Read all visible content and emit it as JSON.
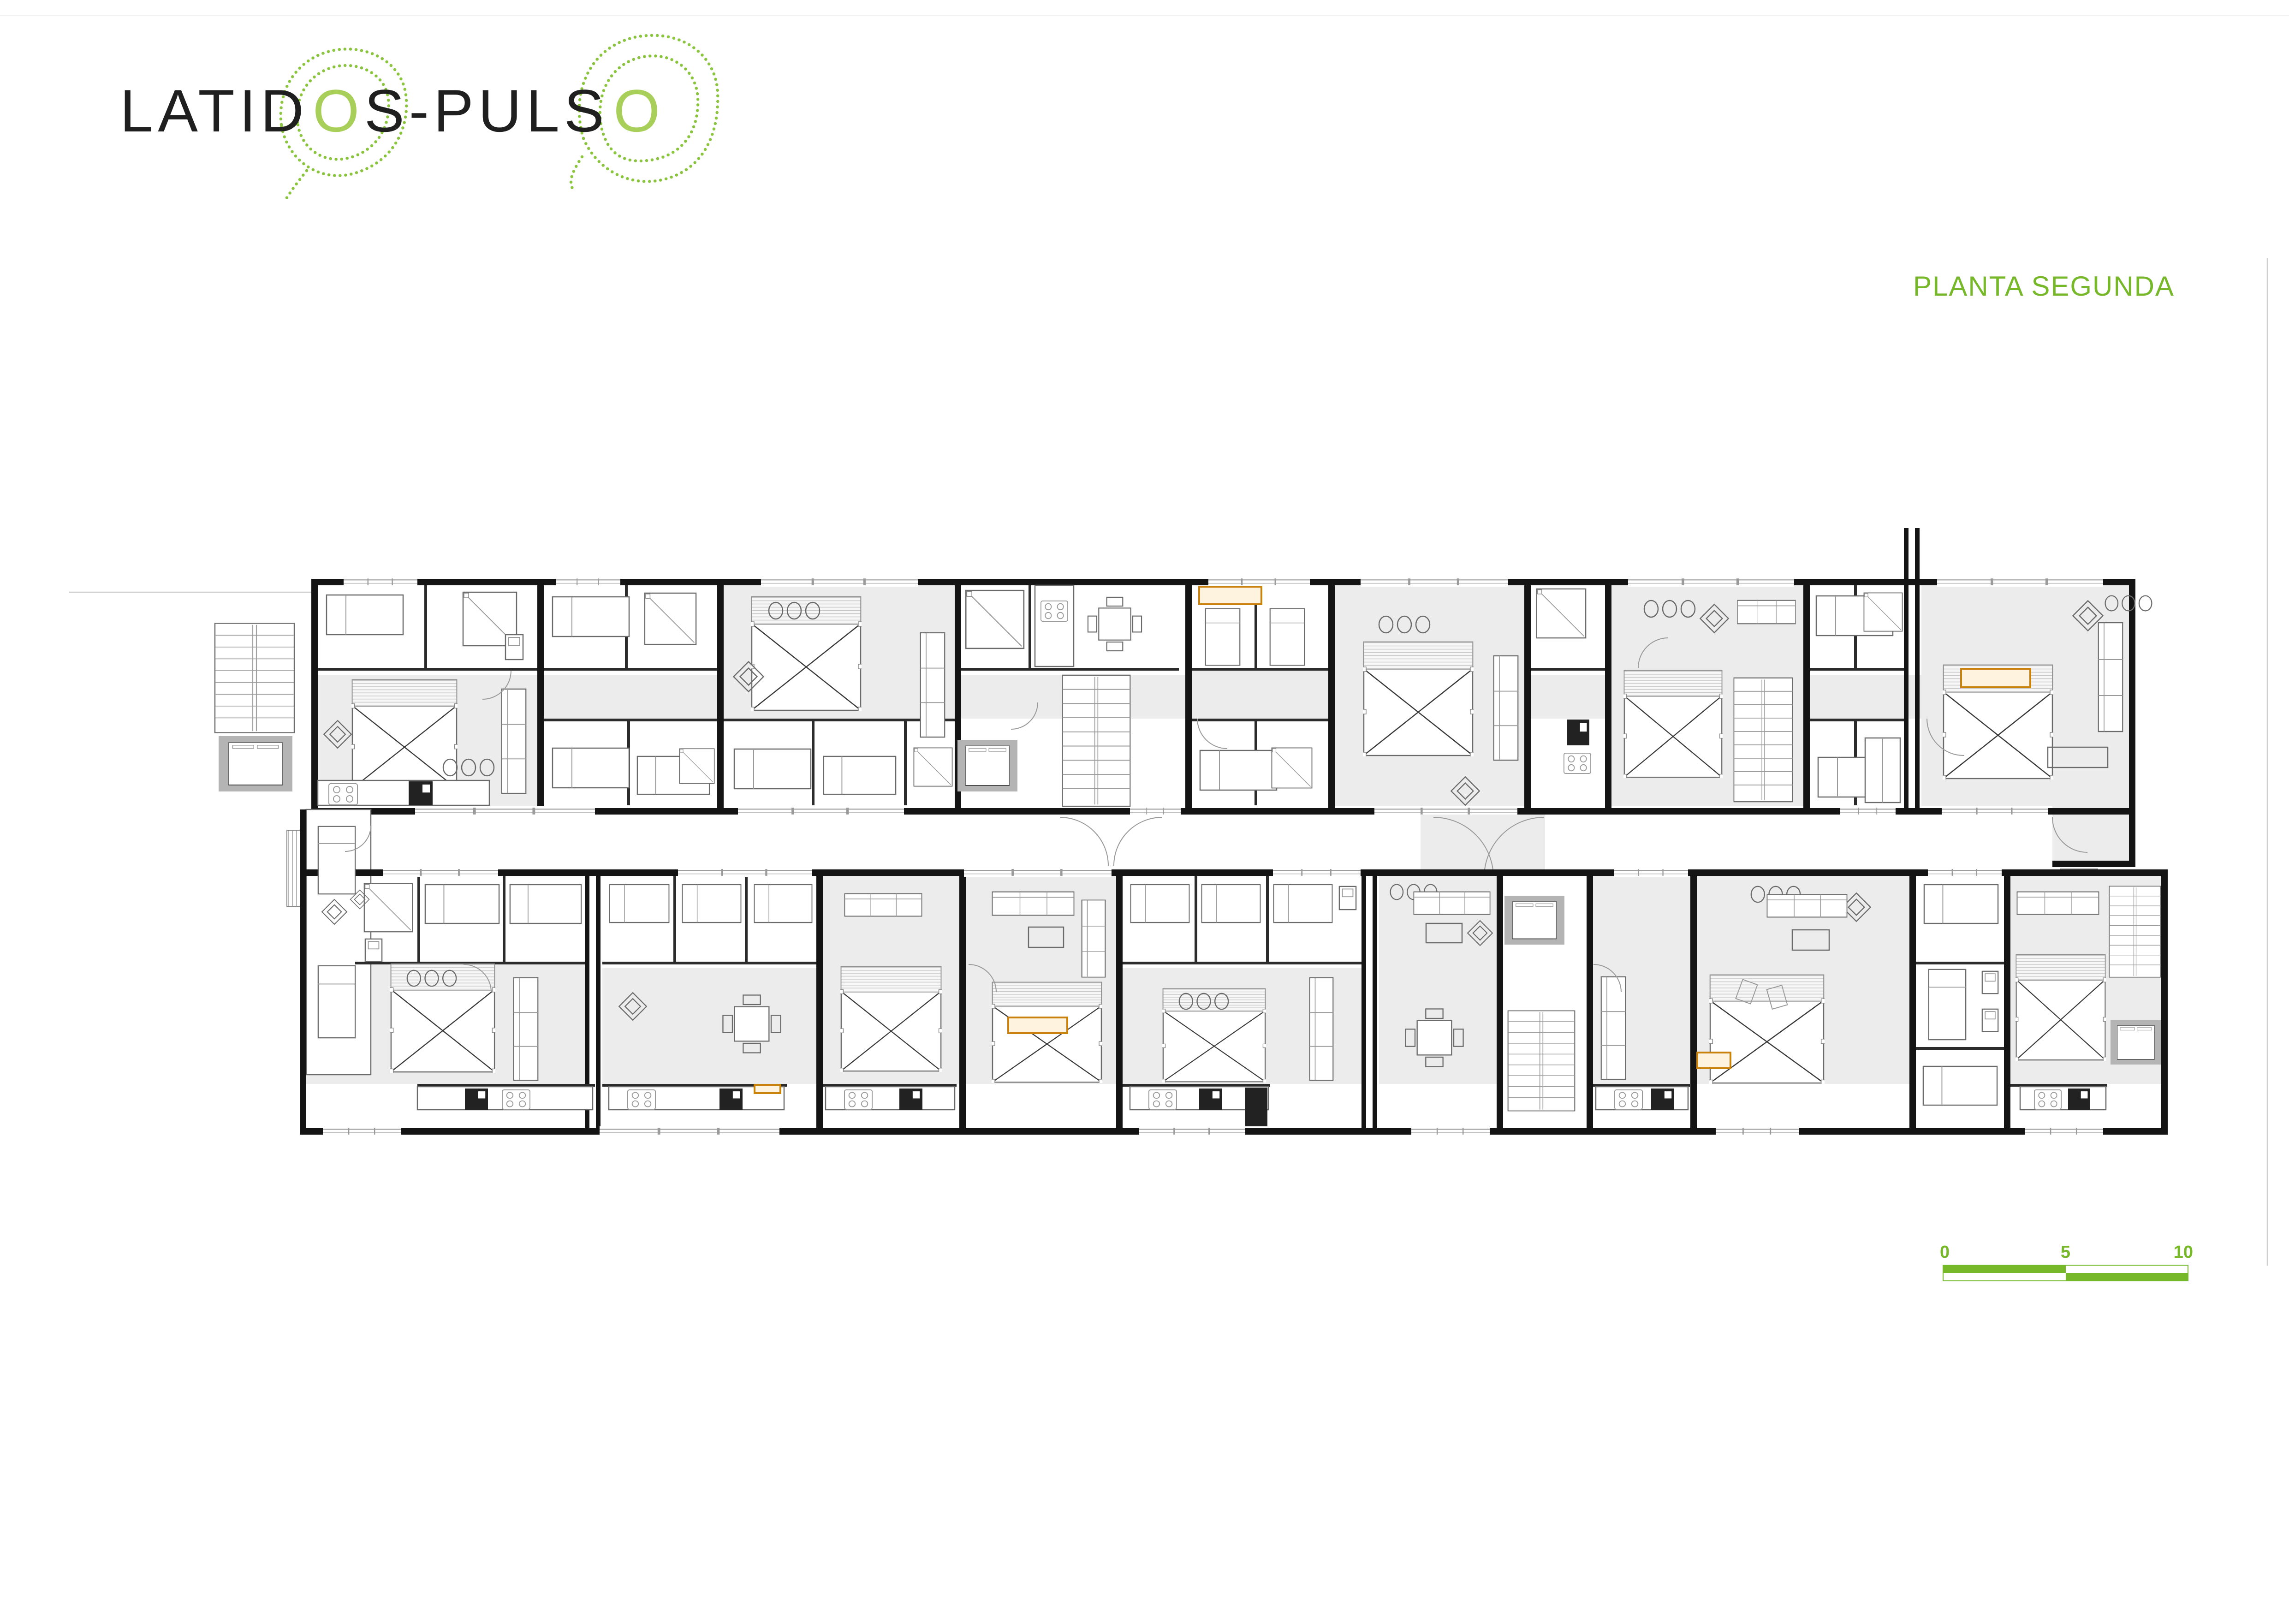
{
  "logo": {
    "part1": "LATID",
    "o1": "O",
    "part2": "S-PULS",
    "o2": "O"
  },
  "title": "PLANTA SEGUNDA",
  "scale_bar": {
    "labels": [
      "0",
      "5",
      "10"
    ]
  },
  "colors": {
    "accent_green": "#76b82a",
    "logo_o_green": "#a8cf5a",
    "contour_dot_green": "#8bc53f",
    "highlight_orange": "#c9820e",
    "wall_black": "#141414",
    "floor_gray": "#ececec",
    "shaft_gray": "#b4b4b4"
  }
}
